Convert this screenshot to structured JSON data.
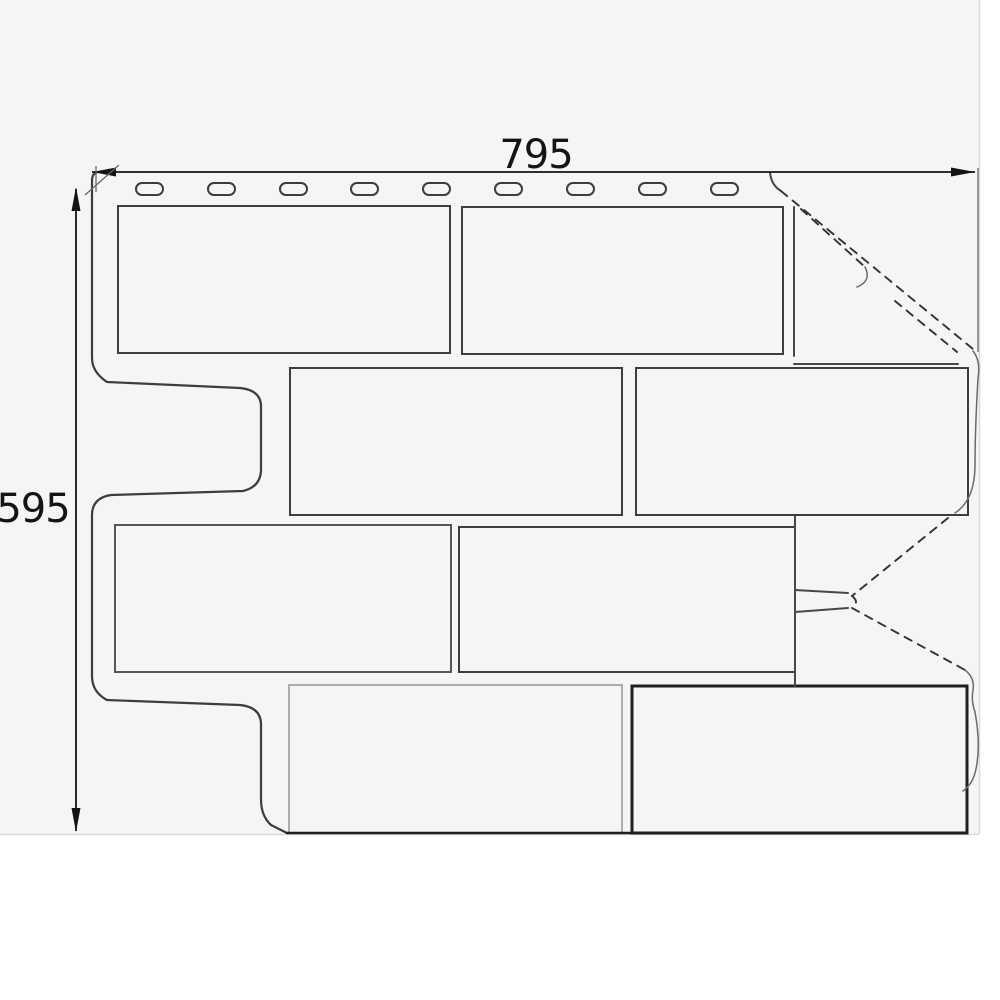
{
  "drawing": {
    "kind": "technical line drawing",
    "subject": "corner facade siding panel with brick texture, front view",
    "width_label": "795",
    "height_label": "595",
    "width_value": 795,
    "height_value": 595,
    "colors": {
      "paper": "#f5f5f3",
      "page_white": "#ffffff",
      "line_dark": "#1f1f1f",
      "line_medium": "#3d3d3d",
      "line_light": "#9b9b9b",
      "dashed": "#333333",
      "faint": "#d9d9d9",
      "text": "#141414"
    },
    "nail_slots": {
      "count": 9,
      "y": 183,
      "w": 27,
      "h": 12,
      "r": 6,
      "xs": [
        136,
        208,
        280,
        351,
        423,
        495,
        567,
        639,
        711
      ]
    },
    "bricks": [
      {
        "x": 118,
        "y": 206,
        "w": 332,
        "h": 147,
        "tone": "medium"
      },
      {
        "x": 462,
        "y": 207,
        "w": 321,
        "h": 147,
        "tone": "medium"
      },
      {
        "x": 290,
        "y": 368,
        "w": 332,
        "h": 147,
        "tone": "medium"
      },
      {
        "x": 636,
        "y": 368,
        "w": 332,
        "h": 147,
        "tone": "medium"
      },
      {
        "x": 115,
        "y": 525,
        "w": 336,
        "h": 147,
        "tone": "soft"
      },
      {
        "x": 459,
        "y": 527,
        "w": 336,
        "h": 145,
        "tone": "medium"
      },
      {
        "x": 289,
        "y": 685,
        "w": 333,
        "h": 148,
        "tone": "light"
      },
      {
        "x": 632,
        "y": 686,
        "w": 335,
        "h": 147,
        "tone": "dark"
      }
    ]
  }
}
